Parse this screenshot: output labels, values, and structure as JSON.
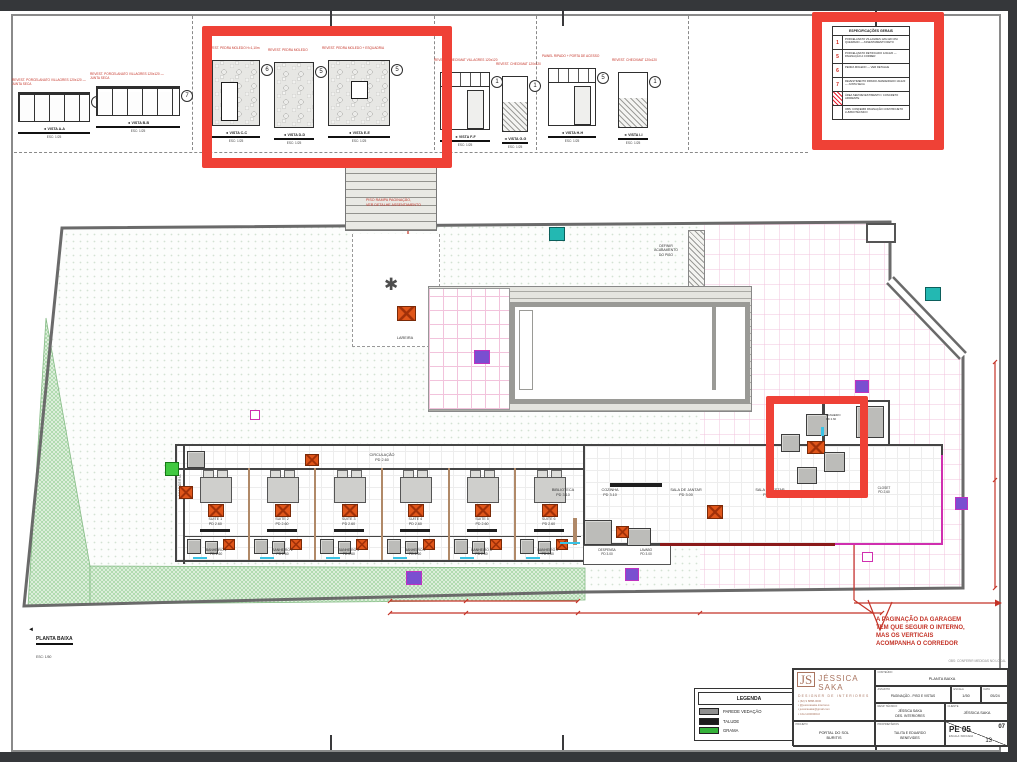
{
  "app": {
    "background": "#35373a"
  },
  "details": {
    "groups": [
      {
        "type": "cabinet",
        "num": "7",
        "note": "REVEST. PORCELANATO VILLAGRES 120x120 — JUNTA SECA",
        "caption": "◄ VISTA A-A",
        "scale": "ESC: 1/25"
      },
      {
        "type": "cabinet",
        "num": "7",
        "note": "REVEST. PORCELANATO VILLAGRES 120x120 — JUNTA SECA",
        "caption": "◄ VISTA B-B",
        "scale": "ESC: 1/25"
      },
      {
        "type": "stone-door",
        "num": "6",
        "note": "REVEST. PEDRA MOLEDO H=1,10m",
        "caption": "◄ VISTA C-C",
        "scale": "ESC: 1/25"
      },
      {
        "type": "stone",
        "num": "5",
        "note": "REVEST. PEDRA MOLEDO",
        "caption": "◄ VISTA D-D",
        "scale": "ESC: 1/25"
      },
      {
        "type": "stone-window",
        "num": "5",
        "note": "REVEST. PEDRA MOLEDO + ESQUADRIA",
        "caption": "◄ VISTA E-E",
        "scale": "ESC: 1/25"
      },
      {
        "type": "door",
        "num": "1",
        "note": "REVEST. CHECKMAT VILLAGRES 120x120",
        "caption": "◄ VISTA F-F",
        "scale": "ESC: 1/25"
      },
      {
        "type": "hatch",
        "num": "1",
        "note": "REVEST. CHECKMAT 120x120",
        "caption": "◄ VISTA G-G",
        "scale": "ESC: 1/25"
      },
      {
        "type": "door",
        "num": "5",
        "note": "PAINEL RIPADO + PORTA DE ACESSO",
        "caption": "◄ VISTA H-H",
        "scale": "ESC: 1/25"
      },
      {
        "type": "hatch",
        "num": "1",
        "note": "REVEST. CHECKMAT 120x120",
        "caption": "◄ VISTA I-I",
        "scale": "ESC: 1/25"
      }
    ]
  },
  "spec": {
    "title": "ESPECIFICAÇÕES GERAIS",
    "rows": [
      {
        "num": "1",
        "text": "PORCELANATO VILLAGRES 120x120 CIM. QUEIMADO — ASSENTAMENTO RETO",
        "hatch": false
      },
      {
        "num": "5",
        "text": "PORCELANATO RETIFICADO 120x120 — PAGINAÇÃO A CORRER",
        "hatch": false
      },
      {
        "num": "6",
        "text": "PEDRA MOLEDO — VER DETALHE",
        "hatch": false
      },
      {
        "num": "7",
        "text": "REVESTIMENTO RIPADO AMADEIRADO 10x120 — JUNTA SECA",
        "hatch": false
      },
      {
        "num": "",
        "text": "ÁREA SEM REVESTIMENTO / CONCRETO APARENTE",
        "hatch": true
      },
      {
        "num": "",
        "text": "OBS: CONFERIR PAGINAÇÃO COM PROJETO LUMINOTÉCNICO",
        "hatch": false
      }
    ]
  },
  "plan": {
    "rooms": {
      "circulacao": "CIRCULAÇÃO\nPD 2.60",
      "biblioteca": "BIBLIOTECA\nPD 3.10",
      "cozinha": "COZINHA\nPD 3.10",
      "jantar": "SALA DE JANTAR\nPD 3.00",
      "estar": "SALA DE ESTAR\nPD 3.00",
      "despensa": "DESPENSA\nPD 3.00",
      "lavabo": "LAVABO\nPD 3.00",
      "banheiro_box": "BANHEIRO\nPD 2.60",
      "closet": "CLOSET\nPD 2.60",
      "lavanderia": "LAVANDERIA",
      "lareira": "LAREIRA",
      "definir": "DEFINIR\nACABAMENTO\nDO PISO"
    },
    "suites": [
      {
        "label": "SUITE 1\nPD 2.60"
      },
      {
        "label": "SUITE 2\nPD 2.60"
      },
      {
        "label": "SUITE 3\nPD 2.60"
      },
      {
        "label": "SUITE 4\nPD 2.60"
      },
      {
        "label": "SUITE 5\nPD 2.60"
      },
      {
        "label": "SUITE 6\nPD 2.60"
      }
    ],
    "banheiros": [
      {
        "label": "BANHEIRO 1\nPD 2.60"
      },
      {
        "label": "BANHEIRO 2\nPD 2.60"
      },
      {
        "label": "BANHEIRO 3\nPD 2.60"
      },
      {
        "label": "BANHEIRO 4\nPD 2.60"
      },
      {
        "label": "BANHEIRO 5\nPD 2.60"
      },
      {
        "label": "BANHEIRO 6\nPD 2.60"
      }
    ],
    "notes": {
      "piso_rampa": "PISO RAMPA PAGINAÇÃO,\nVER DETALHE ASSENTAMENTO",
      "garagem": "A PAGINAÇÃO DA GARAGEM\nTEM QUE SEGUIR O INTERNO,\nMAS OS VERTICAIS\nACOMPANHA O CORREDOR"
    },
    "caption": {
      "title": "PLANTA BAIXA",
      "scale": "ESC: 1/50"
    }
  },
  "legend": {
    "title": "LEGENDA",
    "items": [
      {
        "label": "PAREDE VEDAÇÃO",
        "color": "#8f8f8f"
      },
      {
        "label": "TALUDE",
        "color": "#1d1d1d"
      },
      {
        "label": "GRAMA",
        "color": "#35b23a"
      }
    ]
  },
  "titleblock": {
    "obs": "OBS: CONFERIR MEDIDAS NO LOCAL",
    "brand": {
      "monogram": "JS",
      "name": "JÉSSICA SAKA",
      "tagline": "DESIGNER DE INTERIORES",
      "contacts": [
        "▪ (62) 9 8888-0000",
        "▪ @jessicasaka.interiores",
        "▪ jessicasaka@gmail.com",
        "▪ CAU A000000-0"
      ]
    },
    "labels": {
      "conteudo": "CONTEÚDO",
      "assunto": "ASSUNTO",
      "escala": "ESCALA",
      "data": "DATA",
      "resp": "RESP. TÉCNICO",
      "cliente": "CLIENTE",
      "projeto": "PROJETO",
      "prop": "PROPRIETÁRIOS",
      "folha": "FOLHA"
    },
    "values": {
      "conteudo": "PLANTA BAIXA",
      "assunto": "PAGINAÇÃO - PISO E VISTAS",
      "escala": "1/50",
      "data": "05/24",
      "resp": "JÉSSICA SAKA\nDES. INTERIORES",
      "cliente": "JÉSSICA SAKA",
      "projeto": "PORTAL DO SOL\nBURITIS",
      "prop": "TALITA E EDUARDO\nBENEVIDES",
      "code": "PE 05",
      "code_sub": "ESCALA: INDICADA",
      "folha_num": "07",
      "folha_total": "13"
    }
  },
  "colors": {
    "annotation_red": "#ef4136",
    "drawing_red": "#c43327",
    "orange_marker": "#e0561a",
    "purple_marker": "#7a4fd0",
    "teal_marker": "#23b8b2",
    "green_marker": "#41c941",
    "magenta_wall": "#d02fb0",
    "grass_green": "#96cf96",
    "pink_grid": "#f2c3dc"
  }
}
